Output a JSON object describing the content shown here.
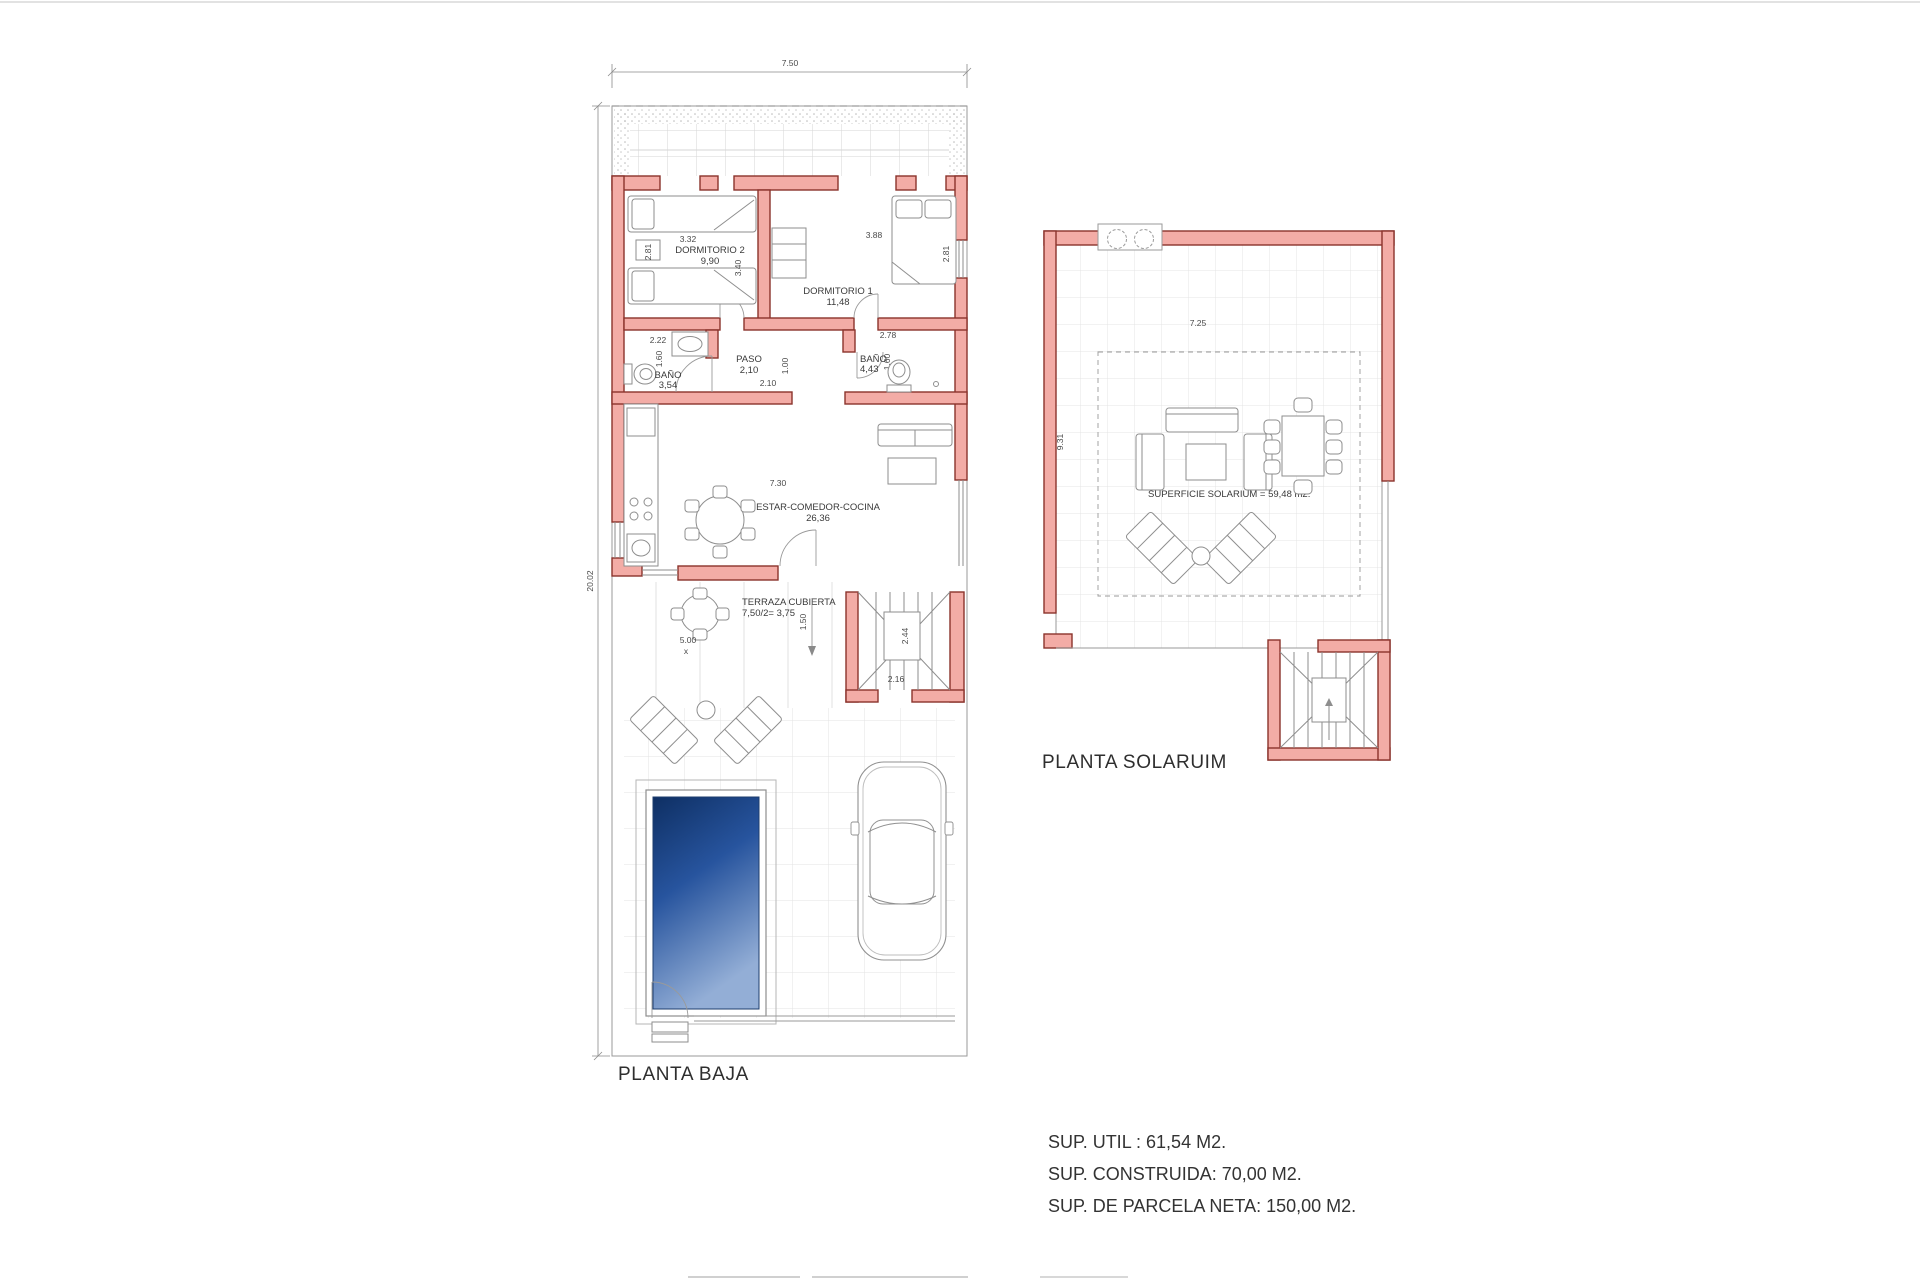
{
  "colors": {
    "wall_fill": "#F3ACA6",
    "wall_stroke": "#8A332C",
    "line_gray": "#8e8e8e",
    "tile_gray": "#e3e3e3",
    "pool_dark": "#0e2f63",
    "pool_light": "#93aed6",
    "text_dark": "#333333"
  },
  "planta_baja": {
    "title": "PLANTA BAJA",
    "dim_width": "7.50",
    "dim_height": "20.02",
    "dormitorio2": {
      "name": "DORMITORIO 2",
      "area": "9,90",
      "dim_w": "3.32",
      "dim_h": "2.81",
      "dim_inner": "3.40"
    },
    "dormitorio1": {
      "name": "DORMITORIO 1",
      "area": "11,48",
      "dim_w": "3.88",
      "dim_h": "2.81"
    },
    "bano1": {
      "name": "BAÑO",
      "area": "3,54",
      "dim_w": "2.22",
      "dim_h": "1.60"
    },
    "paso": {
      "name": "PASO",
      "area": "2,10",
      "dim_w": "2.10",
      "dim_h": "1.00"
    },
    "bano2": {
      "name": "BAÑO",
      "area": "4,43",
      "dim_w": "2.78",
      "dim_h": "1.60"
    },
    "estar": {
      "name": "ESTAR-COMEDOR-COCINA",
      "area": "26,36",
      "dim_w": "7.30"
    },
    "terraza": {
      "name": "TERRAZA CUBIERTA",
      "area": "7,50/2= 3,75",
      "dim_w": "5.00",
      "dim_x": "x",
      "dim_pass": "1.50"
    },
    "escalera": {
      "dim_w": "2.16",
      "dim_h": "2.44"
    }
  },
  "planta_solarium": {
    "title": "PLANTA SOLARUIM",
    "surface_label": "SUPERFICIE SOLARIUM = 59,48 m2.",
    "dim_w": "7.25",
    "dim_h": "9.31"
  },
  "summary": {
    "line1": "SUP. UTIL : 61,54 M2.",
    "line2": "SUP. CONSTRUIDA: 70,00 M2.",
    "line3": "SUP. DE PARCELA NETA: 150,00 M2."
  }
}
